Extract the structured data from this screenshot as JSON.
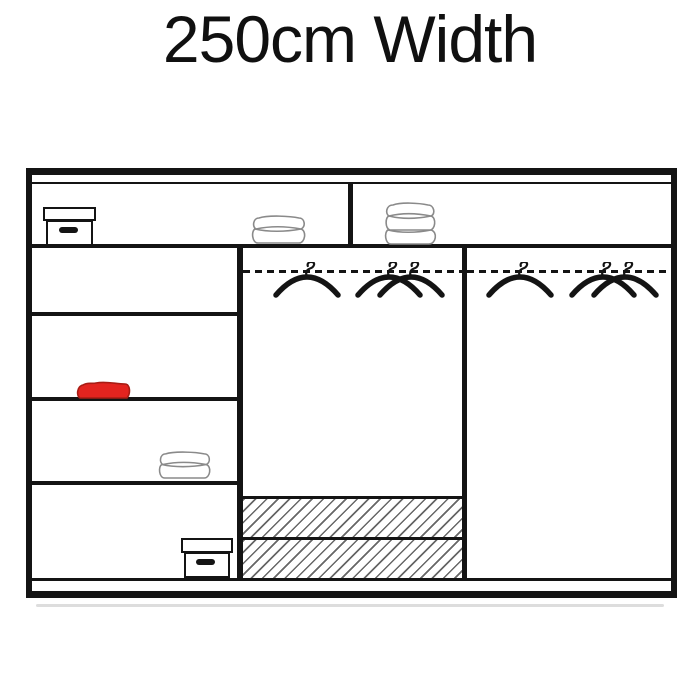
{
  "title": "250cm Width",
  "colors": {
    "line": "#141414",
    "towel_outline": "#8a8a8a",
    "red_item_fill": "#e3241f",
    "red_item_outline": "#a81c14"
  },
  "wardrobe": {
    "type": "sliding-wardrobe-interior-diagram",
    "sections": {
      "top_shelf_left": {
        "items": [
          "storage-box",
          "folded-towel-2-layer"
        ]
      },
      "top_shelf_right": {
        "items": [
          "folded-stack-3-layer"
        ]
      },
      "left_column": {
        "compartments": 4,
        "items": [
          "empty",
          "red-folded-item",
          "folded-towel-2-layer",
          "storage-box"
        ]
      },
      "middle_hanging": {
        "rail_style": "dashed",
        "hanger_count": 3,
        "drawers": {
          "count": 2,
          "style": "hatched"
        }
      },
      "right_hanging": {
        "rail_style": "dashed",
        "hanger_count": 3
      }
    }
  }
}
